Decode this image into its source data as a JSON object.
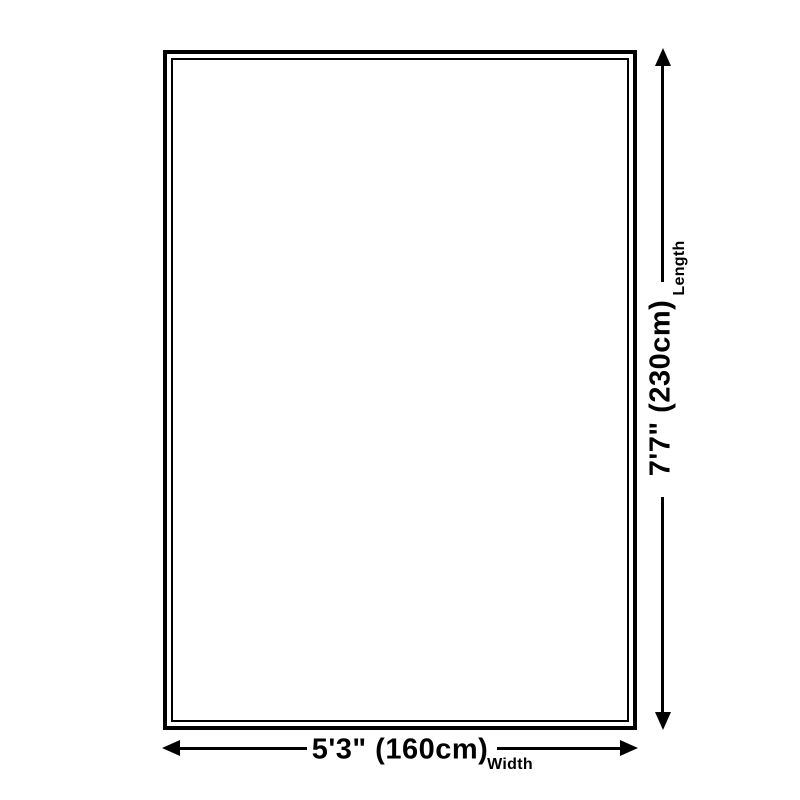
{
  "diagram": {
    "name": "rug-size-diagram",
    "length": {
      "value": "7'7\" (230cm)",
      "label": "Length"
    },
    "width": {
      "value": "5'3\" (160cm)",
      "label": "Width"
    },
    "colors": {
      "line": "#000000",
      "background": "#ffffff"
    }
  }
}
